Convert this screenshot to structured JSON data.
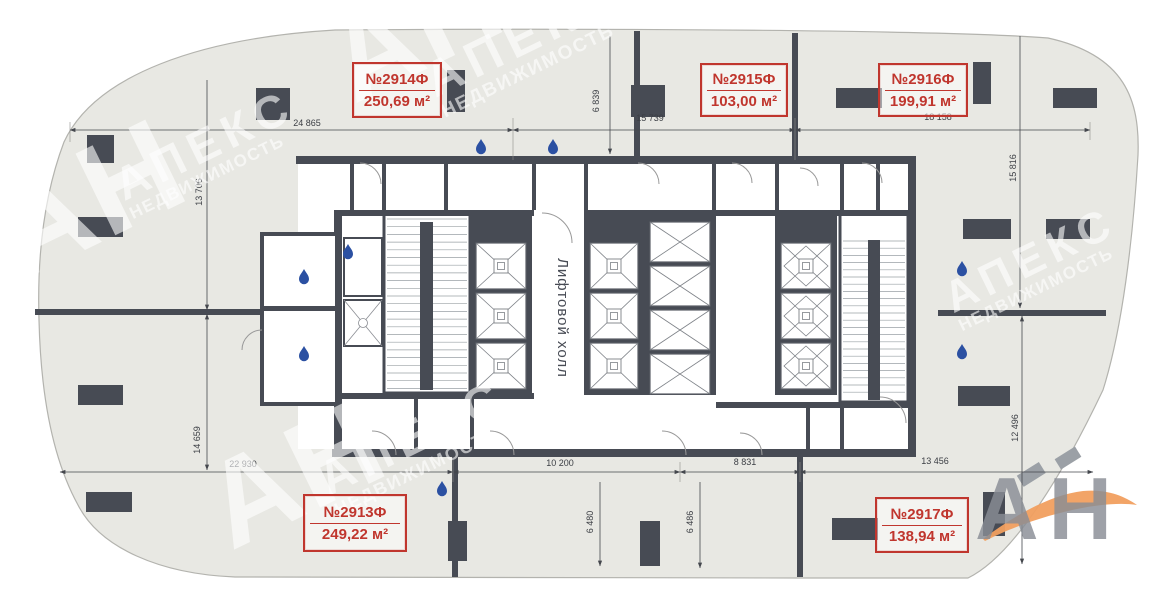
{
  "units": [
    {
      "number": "№2914Ф",
      "area": "250,69 м²"
    },
    {
      "number": "№2915Ф",
      "area": "103,00 м²"
    },
    {
      "number": "№2916Ф",
      "area": "199,91 м²"
    },
    {
      "number": "№2913Ф",
      "area": "249,22 м²"
    },
    {
      "number": "№2917Ф",
      "area": "138,94 м²"
    }
  ],
  "core": {
    "elevator_hall_label": "Лифтовой холл"
  },
  "dimensions": {
    "top": [
      "24 865",
      "15 739",
      "18 158"
    ],
    "bottom": [
      "22 930",
      "10 200",
      "8 831",
      "13 456"
    ],
    "left": [
      "13 706",
      "14 659"
    ],
    "right": [
      "15 816",
      "12 496"
    ],
    "top_vertical": [
      "6 839"
    ],
    "bottom_vertical": [
      "6 480",
      "6 486"
    ]
  },
  "watermark": {
    "initials": "АН",
    "brand": "АПЕКС",
    "sub": "НЕДВИЖИМОСТЬ"
  },
  "brand_logo": {
    "initials": "АН"
  },
  "colors": {
    "wall": "#474b54",
    "floor": "#e8e8e3",
    "unit_label": "#c0362e",
    "dimension_text": "#3b3e44",
    "water_drop": "#2b50a2",
    "swoosh": "#f19f5f",
    "watermark": "rgba(255,255,255,0.6)",
    "logo_letters": "#898d95"
  }
}
